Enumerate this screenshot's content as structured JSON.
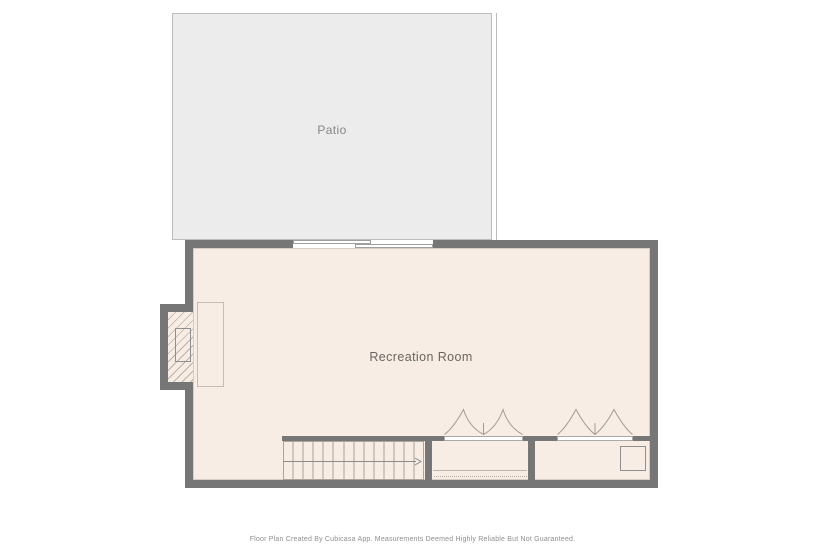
{
  "rooms": {
    "patio": {
      "label": "Patio"
    },
    "recreation_room": {
      "label": "Recreation Room"
    }
  },
  "features": {
    "sliding_door": "sliding patio door",
    "fireplace": "fireplace with hearth",
    "stairs": "staircase with up-direction arrow",
    "closet_left": "closet with bifold doors, shelf and hanging rod",
    "closet_right": "closet with bifold doors and appliance"
  },
  "footer": {
    "disclaimer": "Floor Plan Created By Cubicasa App. Measurements Deemed Highly Reliable But Not Guaranteed."
  },
  "colors": {
    "wall": "#767676",
    "room_fill": "#f7ede4",
    "patio_fill": "#ececec",
    "patio_border": "#bcbcbc",
    "line": "#a8a19a",
    "label_text": "#6b655f",
    "footer_text": "#8f8f8f"
  }
}
